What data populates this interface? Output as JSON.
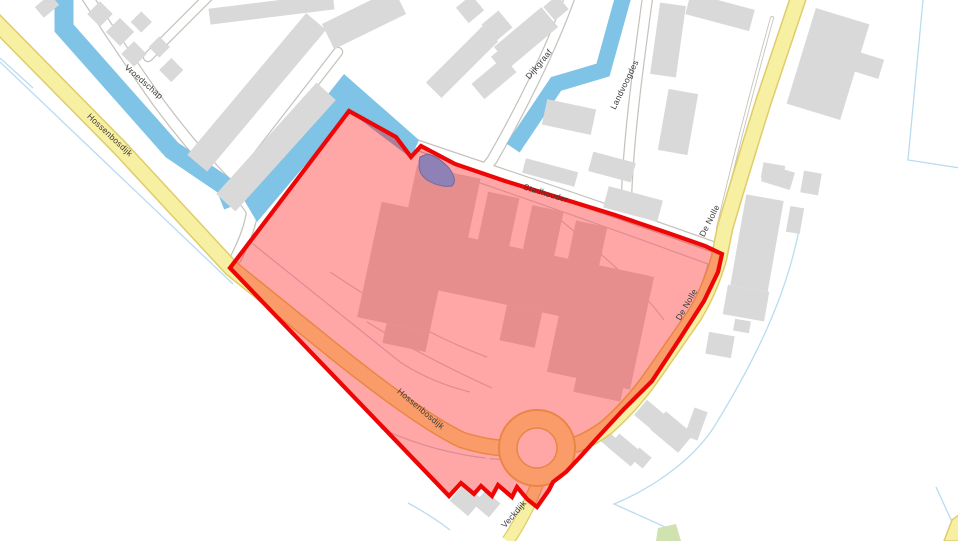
{
  "map": {
    "description": "Street map with a red highlighted selection area covering a building complex, a roundabout and adjoining roads",
    "street_labels": [
      {
        "text": "Vroedschap",
        "placement": "outside-selection, top-left residential street"
      },
      {
        "text": "Hossenbosdijk",
        "placement": "outside-selection, yellow road top-left"
      },
      {
        "text": "Dijkgraaf",
        "placement": "outside-selection, top-centre street"
      },
      {
        "text": "Landvoogdes",
        "placement": "outside-selection, top-centre street near canal"
      },
      {
        "text": "Stadhouder",
        "placement": "along top border of selection"
      },
      {
        "text": "De Nolle",
        "placement": "outside-selection, yellow road right"
      },
      {
        "text": "De Nolle",
        "placement": "inside-selection, orange road right edge"
      },
      {
        "text": "Hossenbosdijk",
        "placement": "inside-selection, orange road lower-left"
      },
      {
        "text": "Veckdijk",
        "placement": "outside-selection, yellow road bottom exit"
      }
    ],
    "selection": {
      "border_color": "#ee0606",
      "fill_color": "rgba(255,0,0,0.345)",
      "contains": [
        "large building complex",
        "roundabout",
        "orange-tinted roads",
        "small purple pond"
      ]
    },
    "palette": {
      "background": "#ffffff",
      "water": "#7fc3e6",
      "building": "#d9d9d9",
      "minor_road": "#ffffff",
      "secondary_road": "#f7efa1",
      "road_casing": "#c7c3bc",
      "secondary_road_casing": "#decd6a",
      "selection_pink": "#ffa7a7",
      "tinted_road_orange": "#f5a05f",
      "tinted_building_rose": "#e08e8e",
      "pond_purple": "#8d81b5",
      "grass_green": "#cfe2b0"
    },
    "features": {
      "roundabout": "orange ring with pink island, bottom centre of selection",
      "canals": "three light-blue canals in upper half",
      "zigzag_border": "saw-tooth selection border along bottom houses"
    }
  }
}
